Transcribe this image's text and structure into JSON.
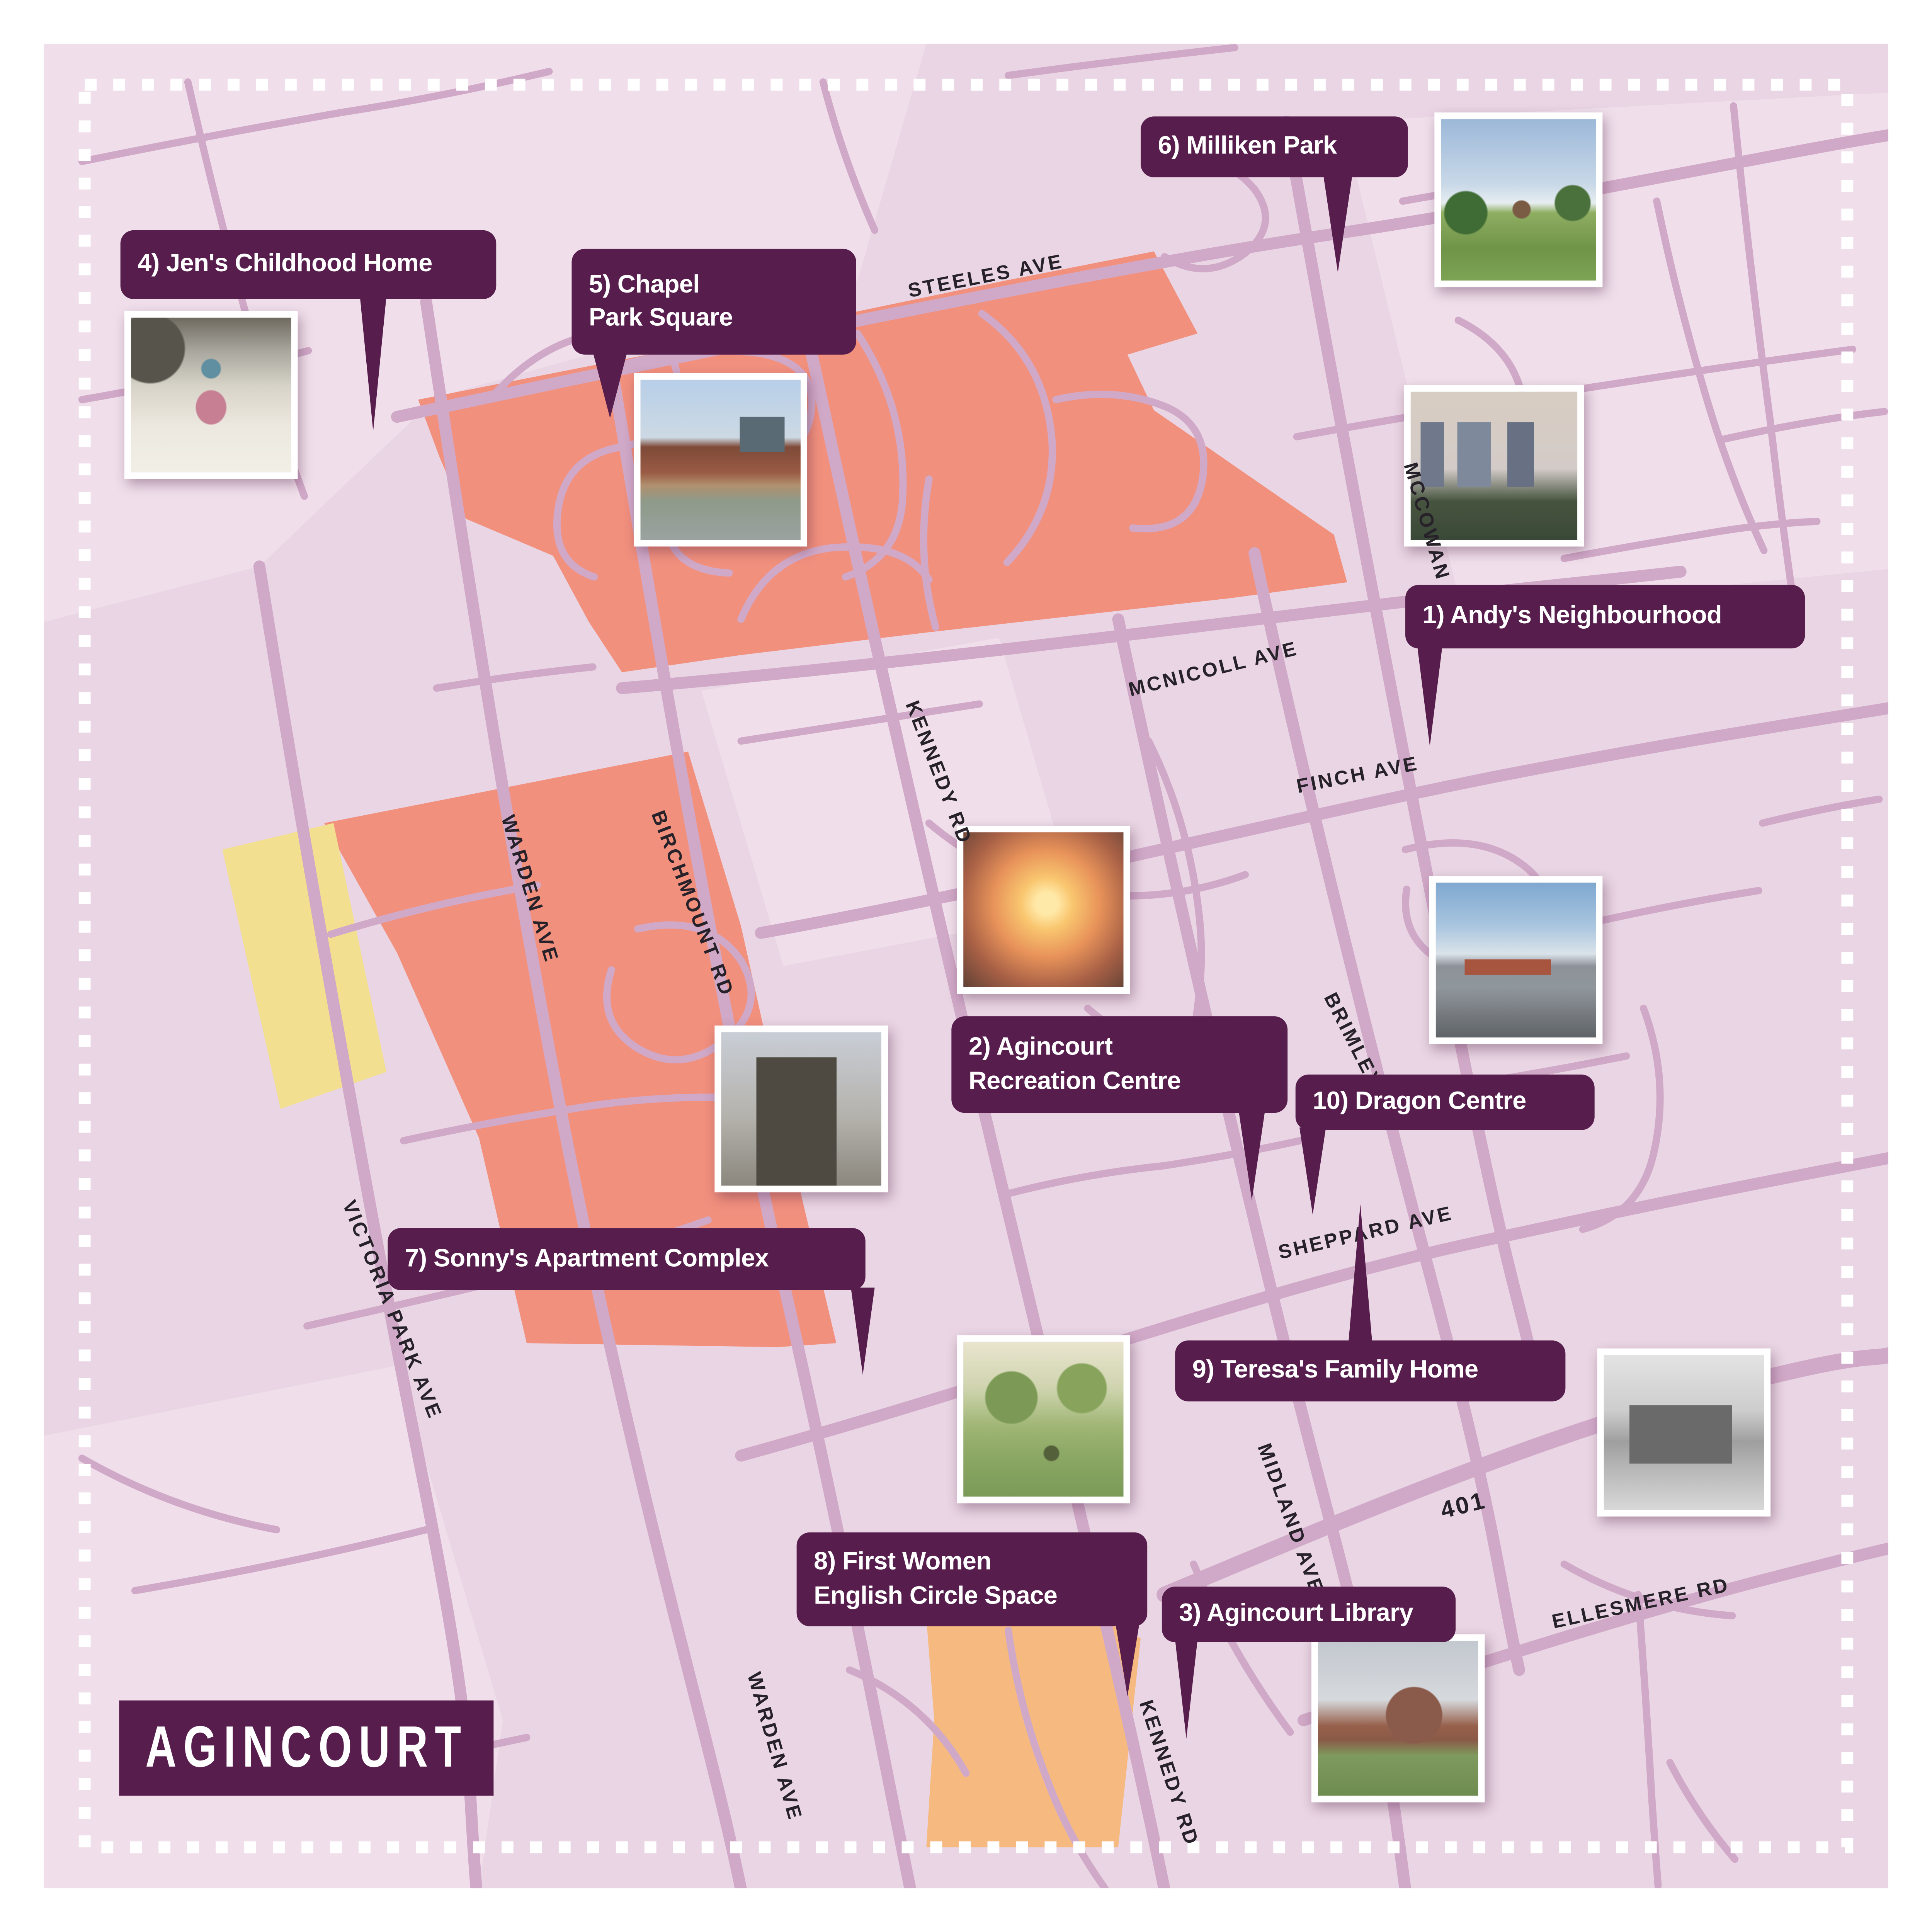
{
  "title": {
    "region_label": "AGINCOURT"
  },
  "locations": [
    {
      "num": "1",
      "text": "1) Andy's Neighbourhood"
    },
    {
      "num": "2",
      "text": "2) Agincourt\nRecreation Centre"
    },
    {
      "num": "3",
      "text": "3) Agincourt Library"
    },
    {
      "num": "4",
      "text": "4) Jen's Childhood Home"
    },
    {
      "num": "5",
      "text": "5) Chapel\nPark Square"
    },
    {
      "num": "6",
      "text": "6) Milliken Park"
    },
    {
      "num": "7",
      "text": "7) Sonny's Apartment Complex"
    },
    {
      "num": "8",
      "text": "8) First Women\nEnglish Circle Space"
    },
    {
      "num": "9",
      "text": "9) Teresa's Family Home"
    },
    {
      "num": "10",
      "text": "10) Dragon Centre"
    }
  ],
  "streets": [
    {
      "name": "STEELES AVE"
    },
    {
      "name": "MCNICOLL AVE"
    },
    {
      "name": "MCCOWAN RD"
    },
    {
      "name": "FINCH AVE"
    },
    {
      "name": "KENNEDY RD"
    },
    {
      "name": "BIRCHMOUNT RD"
    },
    {
      "name": "WARDEN AVE"
    },
    {
      "name": "BRIMLEY RD"
    },
    {
      "name": "SHEPPARD AVE"
    },
    {
      "name": "VICTORIA PARK AVE"
    },
    {
      "name": "MIDLAND AVE"
    },
    {
      "name": "401"
    },
    {
      "name": "ELLESMERE RD"
    },
    {
      "name": "WARDEN AVE"
    },
    {
      "name": "KENNEDY RD"
    }
  ],
  "colors": {
    "callout_bg": "#571e4d",
    "map_bg": "#e9d5e3",
    "road": "#d1a9c8",
    "highlight_salmon": "#f2907e",
    "highlight_yellow": "#f3df90",
    "highlight_orange": "#f6ba80",
    "street_text": "#27222a",
    "frame": "#ffffff"
  }
}
